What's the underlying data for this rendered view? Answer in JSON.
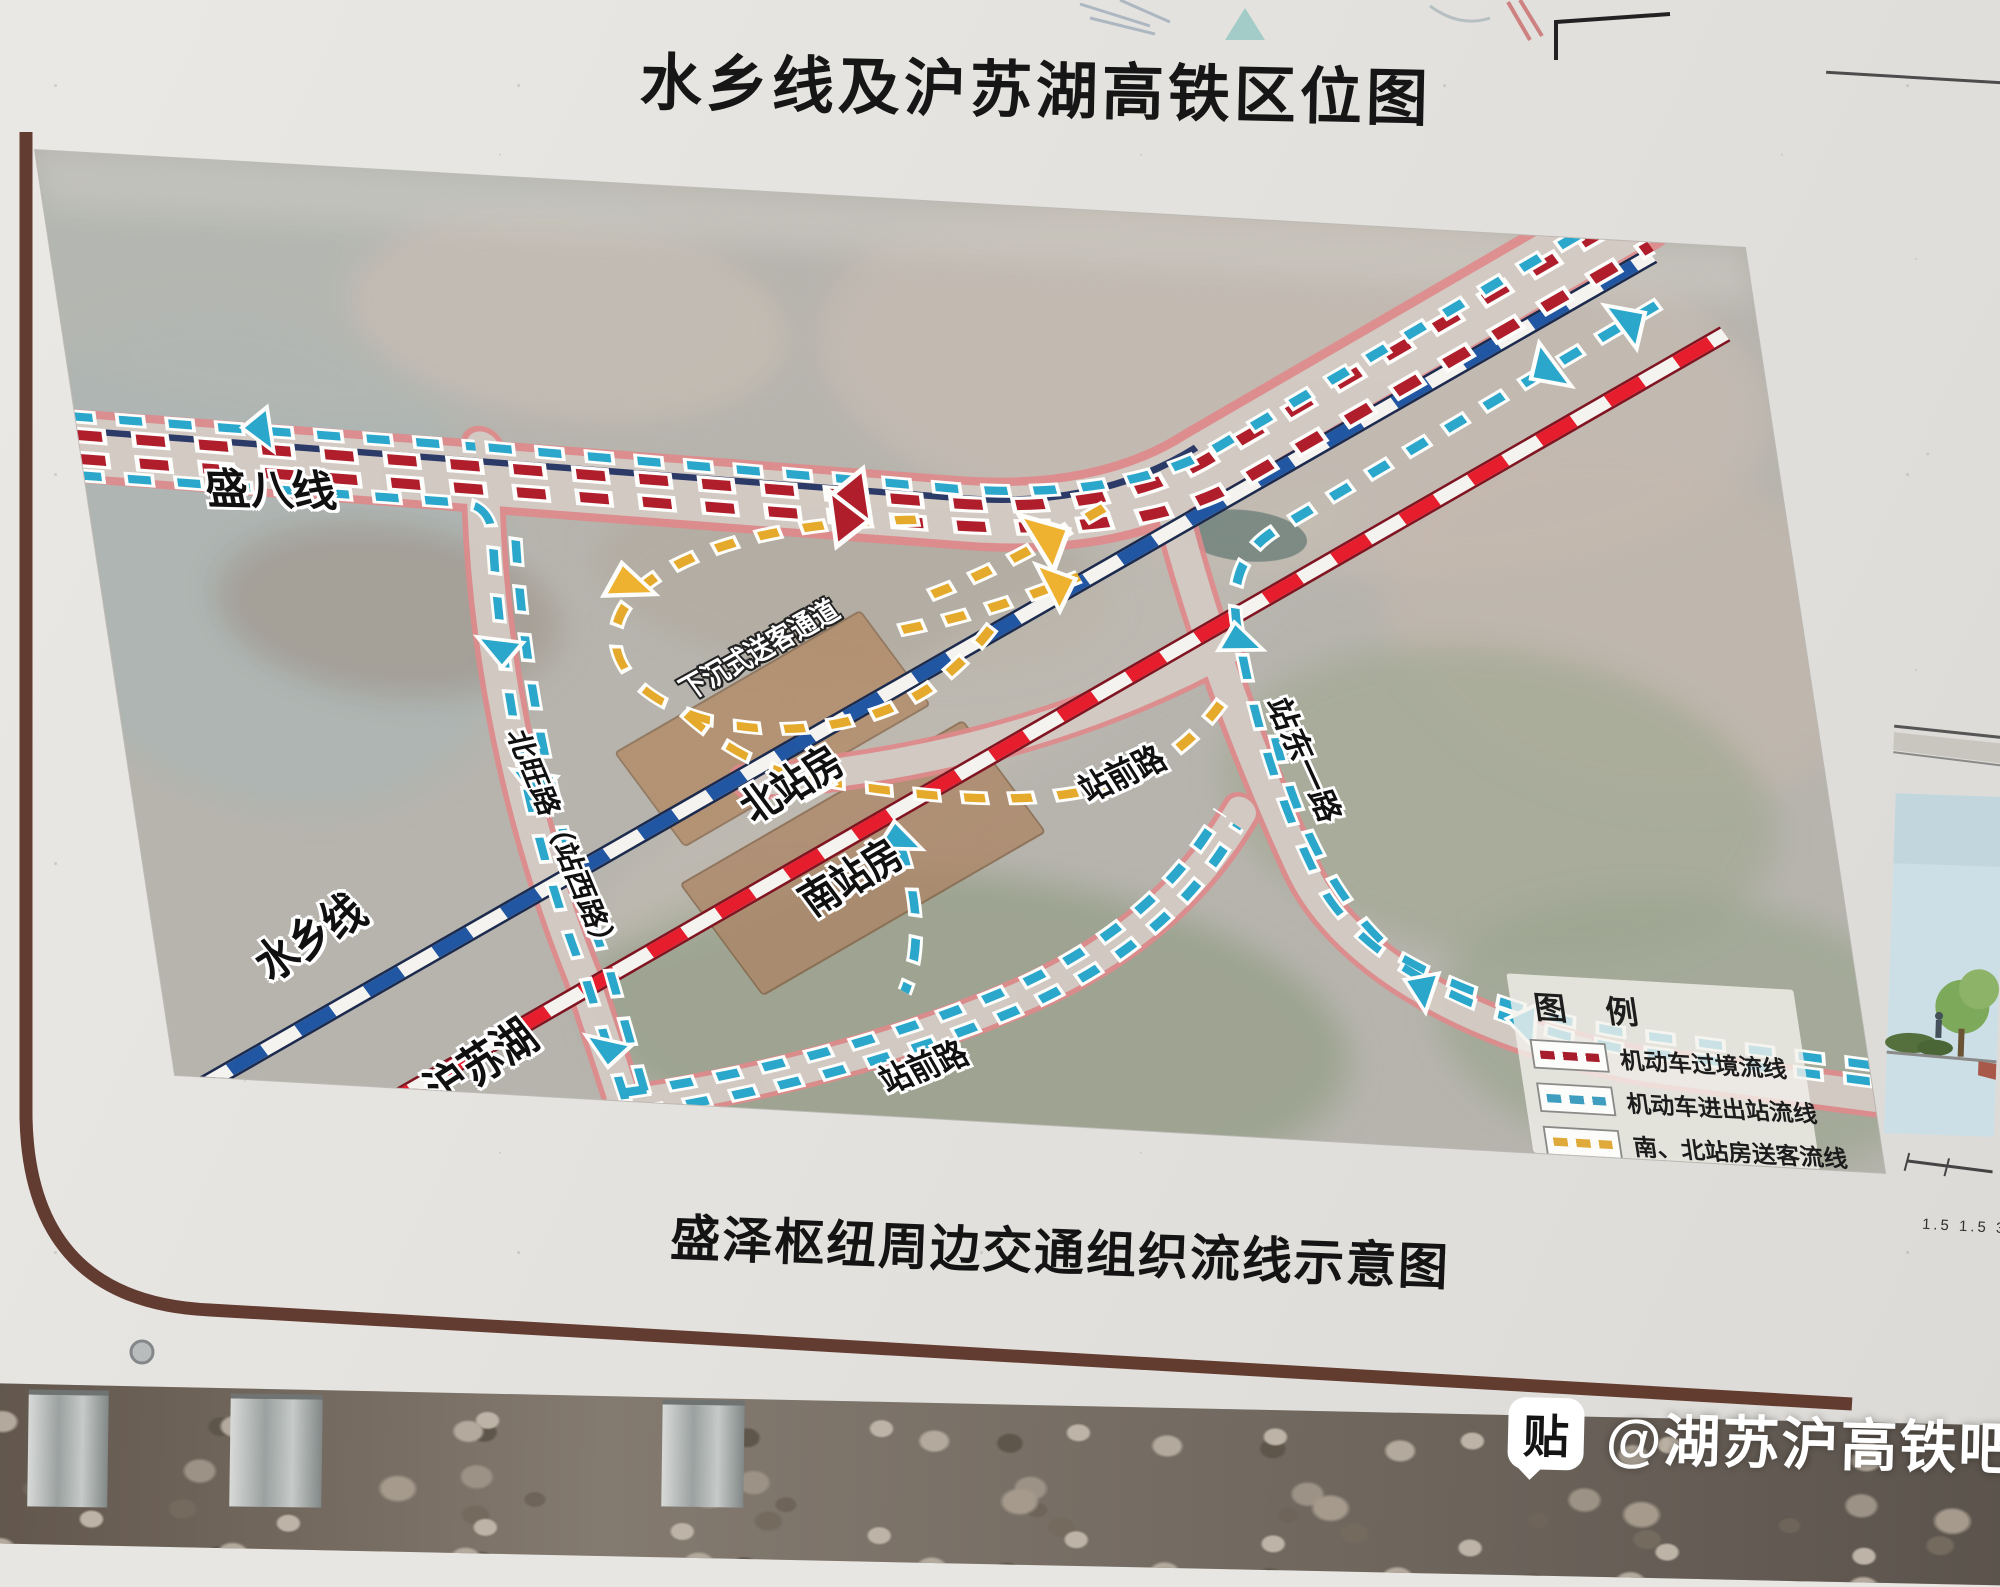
{
  "board": {
    "title": "水乡线及沪苏湖高铁区位图",
    "caption": "盛泽枢纽周边交通组织流线示意图"
  },
  "map": {
    "labels": {
      "sheng_ba_line": "盛八线",
      "shuixiang_line": "水乡线",
      "hu_su_hu_line": "沪苏湖",
      "north_station": "北站房",
      "south_station": "南站房",
      "sunken_passage": "下沉式送客通道",
      "zhanqian_road_upper": "站前路",
      "zhanqian_road_lower": "站前路",
      "zhandong_first_road": "站东一路",
      "beiwang_road": "北旺路（站西路）"
    },
    "legend": {
      "title": "图 例",
      "items": [
        {
          "label": "机动车过境流线",
          "color": "#a81d2b"
        },
        {
          "label": "机动车进出站流线",
          "color": "#3f9ec0"
        },
        {
          "label": "南、北站房送客流线",
          "color": "#dfaa3a"
        }
      ]
    },
    "colors": {
      "shuixiang_rail": "#2156a2",
      "hu_su_hu_rail": "#e51d2d",
      "transit_flow": "#b01e2c",
      "in_out_flow": "#2ba7cb",
      "dropoff_flow": "#e5aa2b",
      "road_edge": "#e0898b",
      "station_building": "#b08a66"
    }
  },
  "side_panel": {
    "dimension_text": "1.5 1.5 3"
  },
  "watermark": {
    "icon": "贴",
    "text": "@湖苏沪高铁吧"
  }
}
